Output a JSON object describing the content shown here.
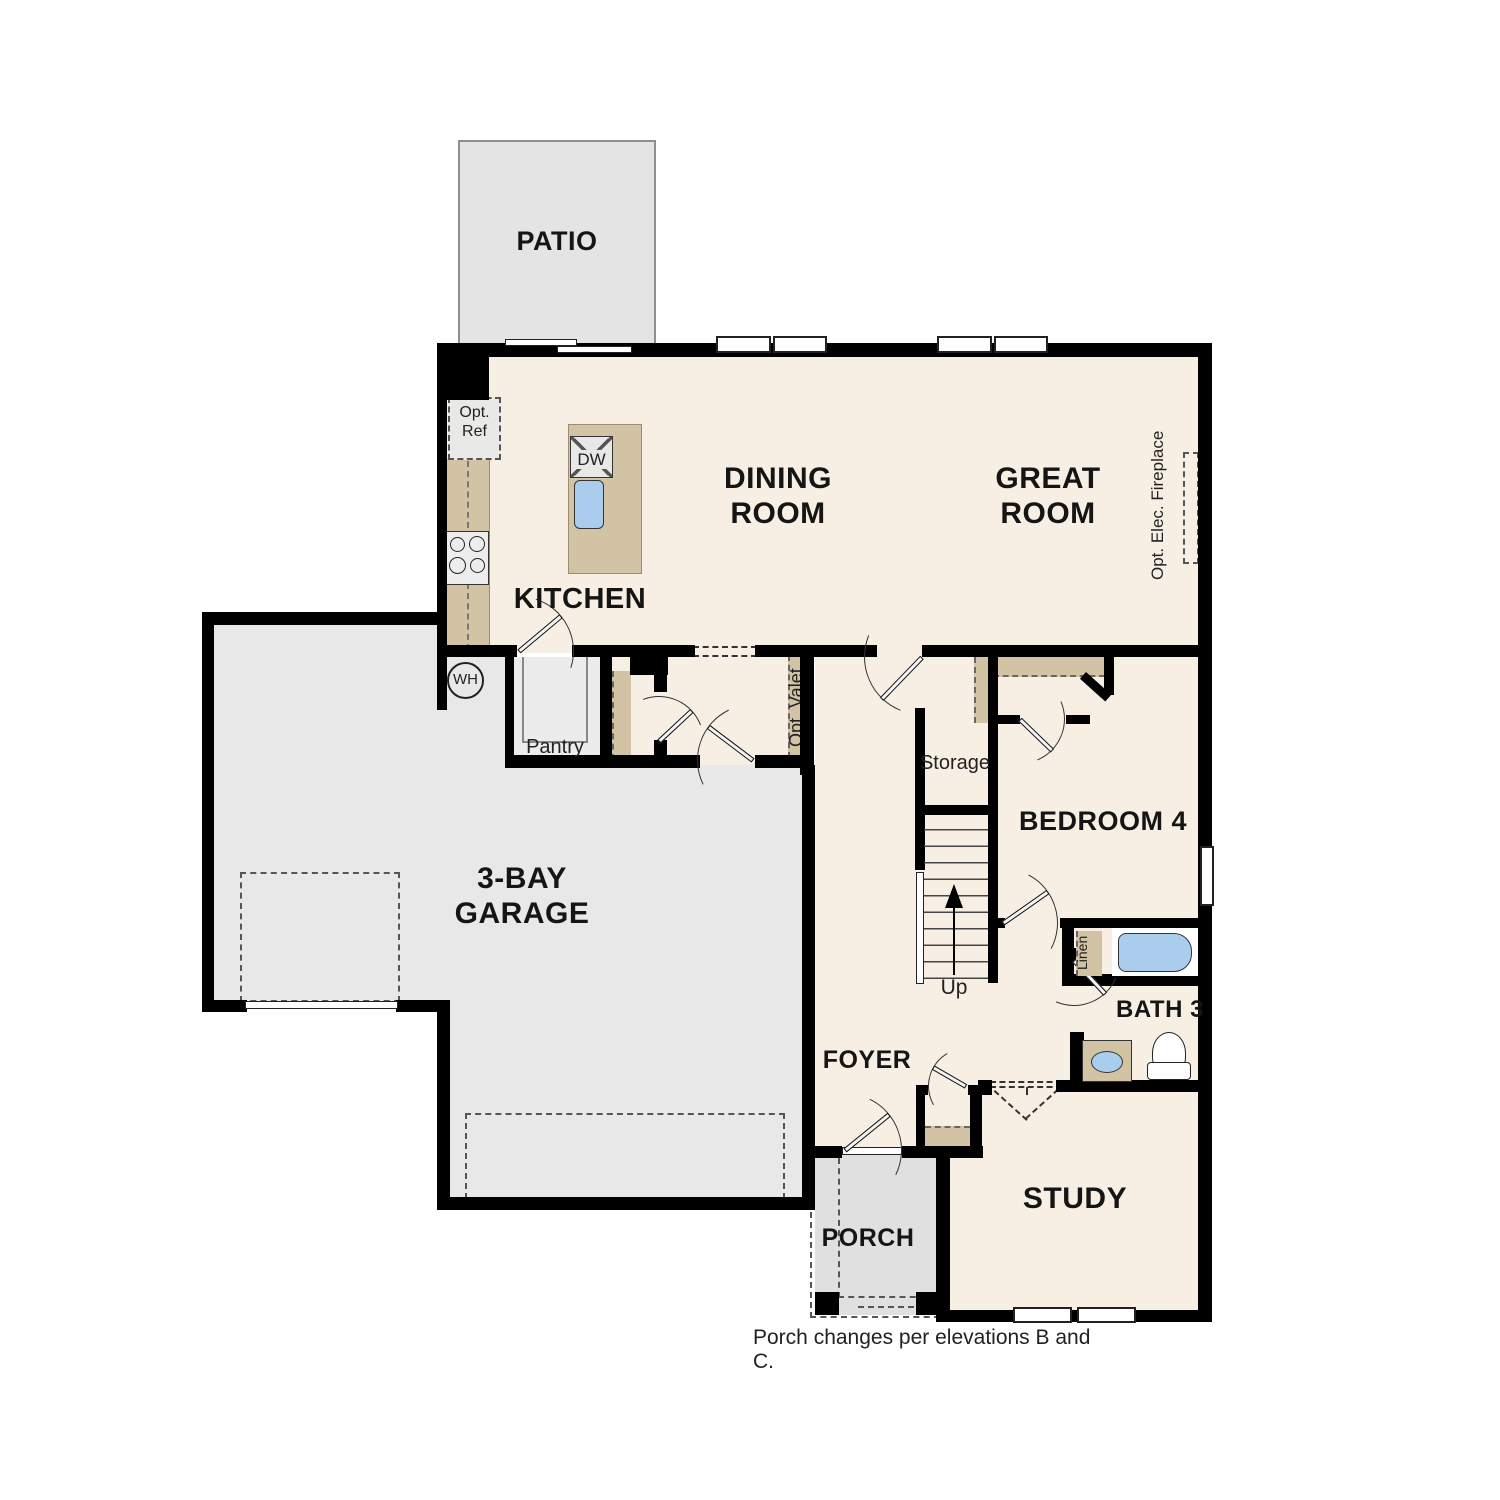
{
  "plan_title": "First floor plan",
  "rooms": {
    "patio": "PATIO",
    "dining": {
      "l1": "DINING",
      "l2": "ROOM"
    },
    "great": {
      "l1": "GREAT",
      "l2": "ROOM"
    },
    "kitchen": "KITCHEN",
    "garage": {
      "l1": "3-BAY",
      "l2": "GARAGE"
    },
    "bedroom4": "BEDROOM 4",
    "bath3": "BATH 3",
    "study": "STUDY",
    "foyer": "FOYER",
    "porch": "PORCH",
    "pantry": "Pantry",
    "storage": "Storage"
  },
  "annotations": {
    "opt_ref": {
      "l1": "Opt.",
      "l2": "Ref"
    },
    "opt_valet": "Opt. Valet",
    "opt_fireplace": "Opt. Elec. Fireplace",
    "linen": "Linen",
    "wh": "WH",
    "dw": "DW",
    "up": "Up"
  },
  "note": "Porch changes per elevations B and C.",
  "colors": {
    "interior": "#f7efe3",
    "casework": "#d2c3a5",
    "garage": "#e8e8e8",
    "patio": "#e4e4e4",
    "porch": "#e0e0e0",
    "pantry": "#ececec",
    "fixture_blue": "#aacdee",
    "wall": "#000000",
    "text": "#151515"
  }
}
